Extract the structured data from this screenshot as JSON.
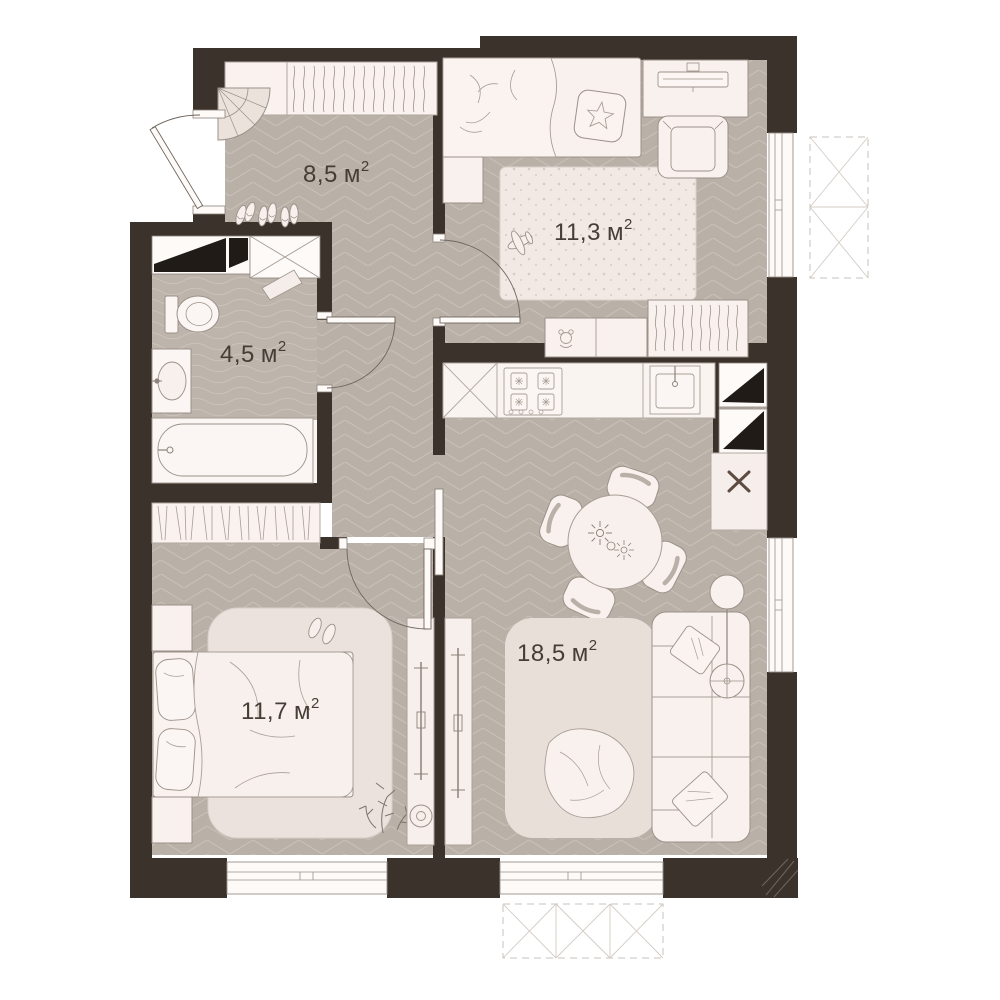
{
  "plan": {
    "rooms": [
      {
        "id": "hallway",
        "area_value": "8,5",
        "unit": "м",
        "sup": "2"
      },
      {
        "id": "kids-bedroom",
        "area_value": "11,3",
        "unit": "м",
        "sup": "2"
      },
      {
        "id": "bathroom",
        "area_value": "4,5",
        "unit": "м",
        "sup": "2"
      },
      {
        "id": "master-bedroom",
        "area_value": "11,7",
        "unit": "м",
        "sup": "2"
      },
      {
        "id": "kitchen-living",
        "area_value": "18,5",
        "unit": "м",
        "sup": "2"
      }
    ],
    "colors": {
      "wall": "#3b322b",
      "floor_base": "#b9b0a8",
      "floor_line": "#c8bfb7",
      "bath_floor": "#bdb4ac",
      "furniture": "#f8f1ee",
      "outline": "#9b9189",
      "vent_black": "#201b17",
      "cross_accent": "#5e4b41",
      "label_text": "#463d36",
      "background": "#ffffff"
    }
  }
}
